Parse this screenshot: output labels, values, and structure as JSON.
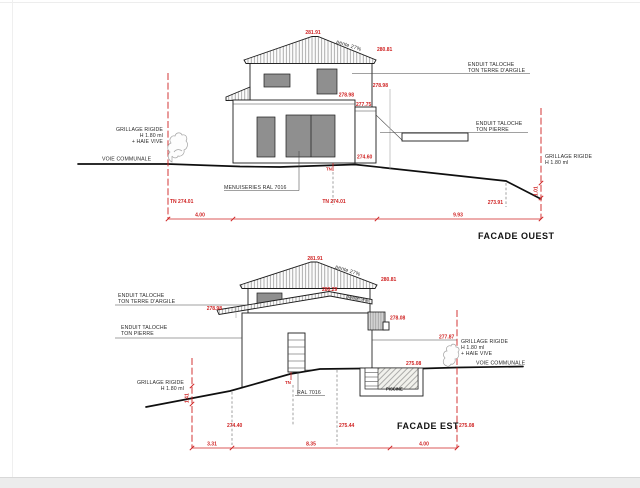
{
  "page": {
    "background": "#ffffff",
    "accent_red": "#cf2222",
    "line_black": "#1c1c1c",
    "window_gray": "#8f8f8f"
  },
  "facade_ouest": {
    "title": "FACADE OUEST",
    "levels": {
      "ridge": "281.91",
      "eave_right": "280.81",
      "floor_right": "278.98",
      "floor_wall": "278.98",
      "annex": "277.75",
      "ground": "274.60",
      "tn_mid_tag": "TN",
      "tn_left": "TN 274.01",
      "tn_mid": "TN 274.01",
      "terrain_right": "273.91"
    },
    "slopes": {
      "roof": "pente 27%"
    },
    "dims": {
      "left": "4.00",
      "right": "9.93",
      "fence_height": "1.01"
    },
    "notes": {
      "fence_left": [
        "GRILLAGE RIGIDE",
        "H 1.80 ml",
        "+ HAIE VIVE"
      ],
      "road": "VOIE COMMUNALE",
      "render_clay": [
        "ENDUIT TALOCHE",
        "TON TERRE D'ARGILE"
      ],
      "render_stone": [
        "ENDUIT TALOCHE",
        "TON PIERRE"
      ],
      "joinery": "MENUISERIES RAL 7016",
      "fence_right": [
        "GRILLAGE RIGIDE",
        "H 1.80 ml"
      ]
    }
  },
  "facade_est": {
    "title": "FACADE EST",
    "levels": {
      "ridge": "281.91",
      "eave_right": "280.81",
      "mid": "280.29",
      "eave_left": "278.98",
      "wall_right": "278.08",
      "terrace": "277.87",
      "pool_deck": "275.08",
      "tn_tag": "TN",
      "ground_left": "274.40",
      "ground_mid": "275.44",
      "ground_right": "275.08"
    },
    "slopes": {
      "roof": "pente 27%",
      "low_roof": "pente 9%"
    },
    "dims": {
      "left": "3.31",
      "mid": "8.35",
      "right": "4.00",
      "fence_height": "1.41"
    },
    "notes": {
      "render_clay": [
        "ENDUIT TALOCHE",
        "TON TERRE D'ARGILE"
      ],
      "render_stone": [
        "ENDUIT TALOCHE",
        "TON PIERRE"
      ],
      "fence_left": [
        "GRILLAGE RIGIDE",
        "H 1.80 ml"
      ],
      "fence_right": [
        "GRILLAGE RIGIDE",
        "H 1.80 ml",
        "+ HAIE VIVE"
      ],
      "road": "VOIE COMMUNALE",
      "joinery": "RAL 7016",
      "pool": "PISCINE"
    }
  }
}
